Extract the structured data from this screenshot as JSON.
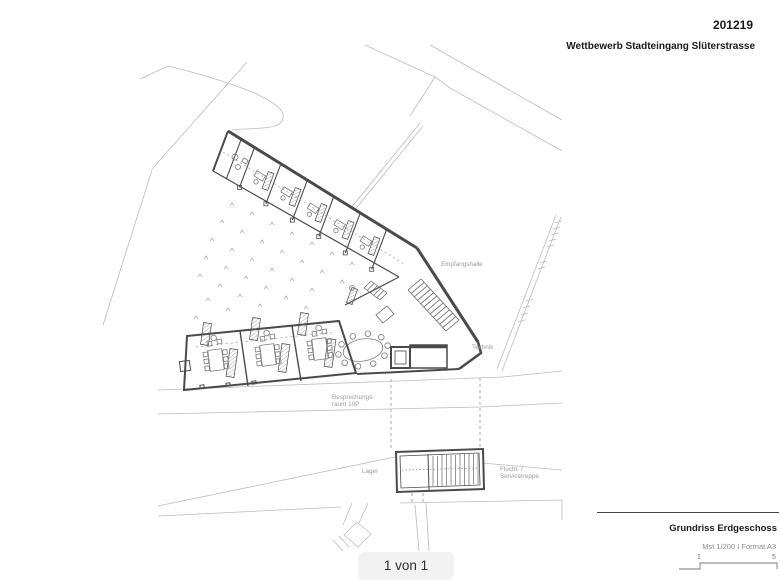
{
  "header": {
    "project_number": "201219",
    "project_title": "Wettbewerb Stadteingang Slüterstrasse"
  },
  "plan": {
    "labels": {
      "empfangshalle": "Empfangshalle",
      "technik": "Technik",
      "besprechung_line1": "Besprechungs-",
      "besprechung_line2": "raum 10P",
      "lager": "Lager",
      "flucht_line1": "Flucht- /",
      "flucht_line2": "Servicetreppe"
    }
  },
  "title_block": {
    "drawing_title": "Grundriss Erdgeschoss",
    "scale_format": "Mst 1/200 I Format A3",
    "scale_start": "1",
    "scale_end": "5"
  },
  "pager": {
    "label": "1 von 1"
  },
  "colors": {
    "background": "#ffffff",
    "context_line": "#bcbcbc",
    "building_line": "#4a4a4a",
    "label_gray": "#9b9b9b",
    "text_dark": "#1a1a1a",
    "pager_bg": "#f2f2f2"
  }
}
